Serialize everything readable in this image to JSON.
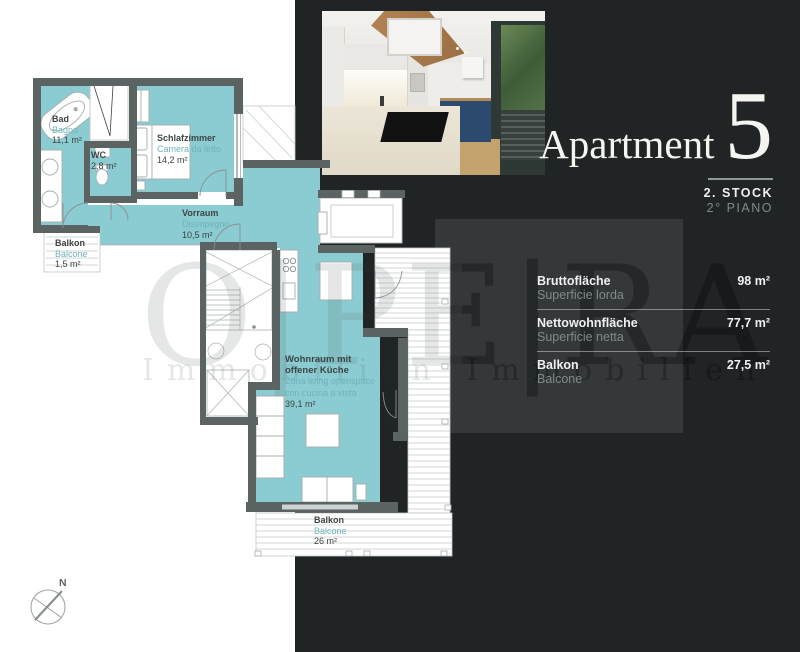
{
  "floor_plan": {
    "rooms": {
      "bad": {
        "name": "Bad",
        "name_it": "Bagno",
        "area": "11,1 m²"
      },
      "wc": {
        "name": "WC",
        "area": "2,8 m²"
      },
      "schlafzimmer": {
        "name": "Schlafzimmer",
        "name_it": "Camera da letto",
        "area": "14,2 m²"
      },
      "balkon_klein": {
        "name": "Balkon",
        "name_it": "Balcone",
        "area": "1,5 m²"
      },
      "vorraum": {
        "name": "Vorraum",
        "name_it": "Disimpegno",
        "area": "10,5 m²"
      },
      "wohnraum": {
        "name_l1": "Wohnraum mit",
        "name_l2": "offener Küche",
        "it_l1": "Zona living openspace",
        "it_l2": "con cucina a vista",
        "area": "39,1 m²"
      },
      "balkon_gross": {
        "name": "Balkon",
        "name_it": "Balcone",
        "area": "26 m²"
      }
    },
    "compass_label": "N"
  },
  "panel": {
    "title": "Apartment",
    "number": "5",
    "floor_de": "2. STOCK",
    "floor_it": "2° PIANO",
    "stats": [
      {
        "label_de": "Bruttofläche",
        "label_it": "Superficie lorda",
        "value": "98 m²"
      },
      {
        "label_de": "Nettowohnfläche",
        "label_it": "Superficie netta",
        "value": "77,7 m²"
      },
      {
        "label_de": "Balkon",
        "label_it": "Balcone",
        "value": "27,5 m²"
      }
    ]
  },
  "watermark": {
    "text": "O|PE|RA",
    "subtext": "Immobilien   Immobilien"
  },
  "colors": {
    "room_fill": "#8accd1",
    "wall": "#5b6363",
    "panel_bg": "#212424",
    "panel_card": "#343838",
    "label_teal": "#6fb3ba",
    "label_dark": "#3c4444"
  }
}
